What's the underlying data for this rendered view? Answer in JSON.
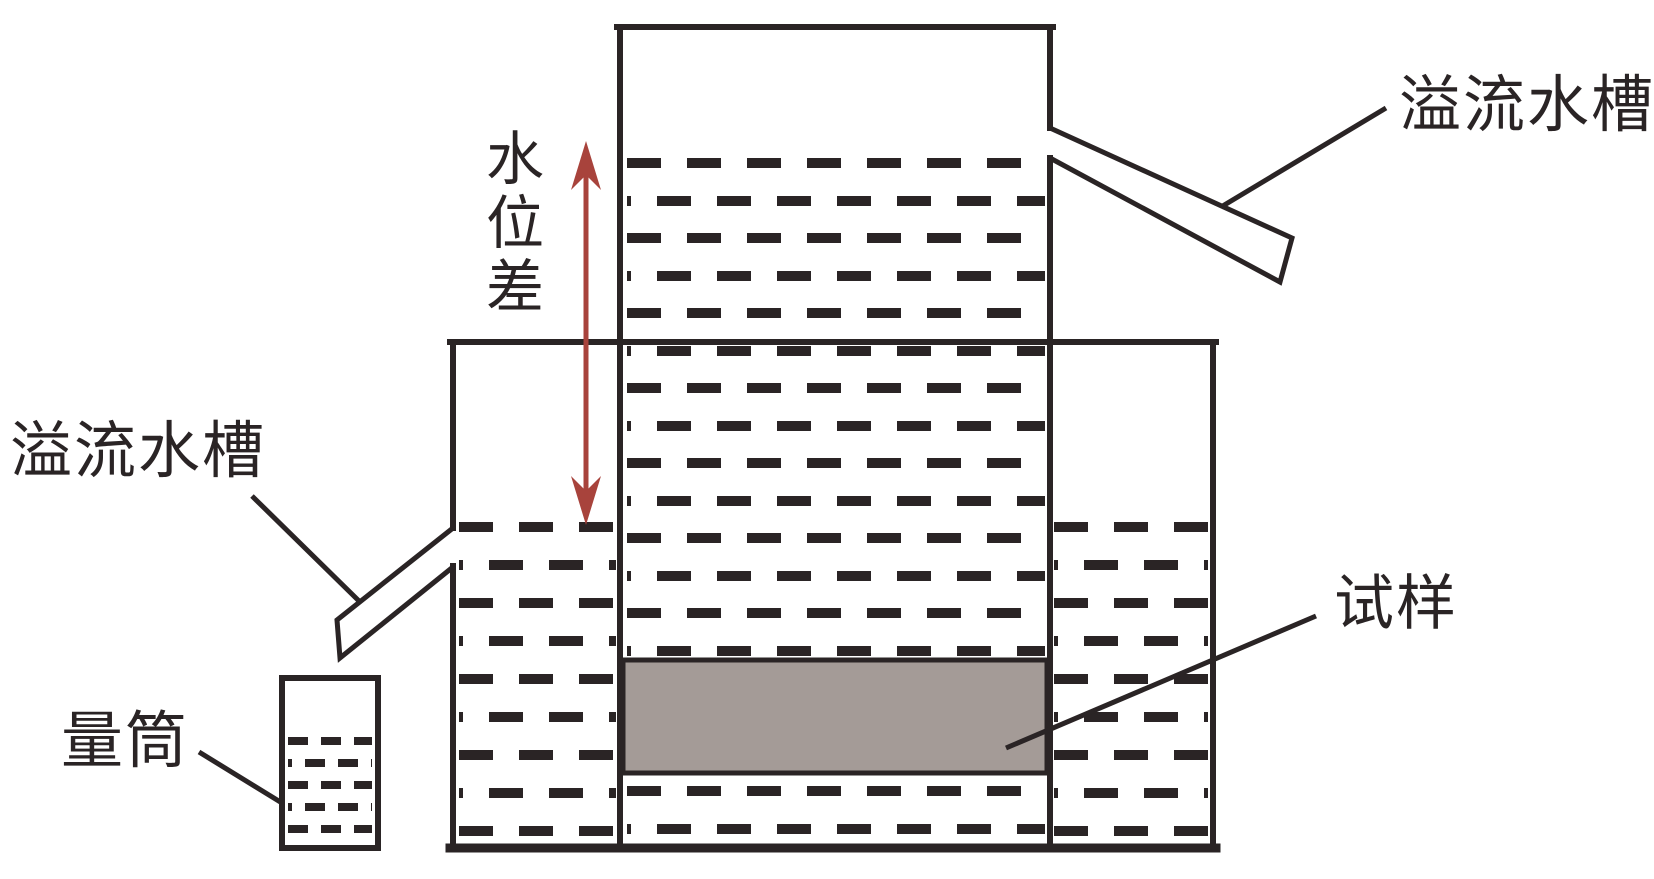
{
  "diagram": {
    "type": "permeability-test-apparatus-schematic",
    "labels": {
      "overflow_tank_top": "溢流水槽",
      "water_level_difference": "水位差",
      "overflow_tank_left": "溢流水槽",
      "measuring_cylinder": "量筒",
      "specimen": "试样"
    },
    "colors": {
      "ink": "#2a2425",
      "accent_red": "#a8433c",
      "specimen_fill": "#a49b97",
      "background": "#ffffff"
    }
  }
}
